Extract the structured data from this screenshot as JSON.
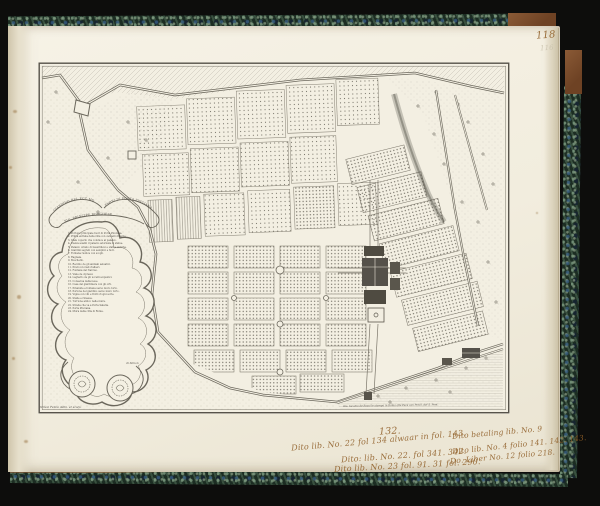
{
  "page": {
    "number": "118",
    "ghost_number": "116"
  },
  "map": {
    "banner": {
      "left": "GIARDINO DEL ECC.MO",
      "center": "SIG. PRINCIPE BORGHESE",
      "right": "FVORI DI PORTA PINCIANA"
    },
    "legend": "1. Portone principale fuori di Porta Pinciana.\n2. Prima entrata della villa con cancelli di ferro.\n3. Viale coperto che conduce al palazzo.\n4. Piazza auanti il palazzo adornata di statue.\n5. Palazzo ornato di bassirilievi e statue antiche.\n6. Giardini segreti con semplici e fiori.\n7. Fontana rustica con scogli.\n8. Ragnaia.\n9. Boschetto.\n10. Recinto de gli animali seluatici.\n11. Prati con viali d'alberi.\n12. Fontana del Narciso.\n13. Viale de cipressi.\n14. Laghetto de gli uccelli acquatici.\n15. Conserua della neue.\n16. Casa del giardiniere con gli orti.\n17. Piramide e fontana uerso muro torto.\n18. Portone del giardino uerso muro torto.\n19. Vigna con viti e frutti d'ogni sorte.\n20. Stalle e rimesse.\n21. Torrione antico nelle mura.\n22. Strada che va a Porta Salaria.\n23. Porta Pinciana.\n24. Mura della citta di Roma.",
    "legend_signature": "di Simon",
    "imprint_left": "Simon Felice delin. et sculp.",
    "imprint_right": "Gio. Iacomo de Rossi le stampa in Roma alla Pace con Priuil. del S. Pont."
  },
  "annotations": {
    "number": "132.",
    "left": [
      "Dito lib. No. 22 fol 134 alwaar in fol. 143.",
      "Dito: lib. No. 22. fol 341. 342.",
      "Dito lib. No. 23 fol. 91. 31 fol. 290."
    ],
    "right": [
      "Dito betaling lib. No. 9",
      "Dito lib. No. 4 folio 141. 142. 143.",
      "Do. Liber No. 12 folio 218."
    ]
  },
  "colors": {
    "background": "#0d0d0c",
    "paper": "#f3efe2",
    "engraving_ink": "#6b675c",
    "manuscript_ink": "#8f5e27",
    "marble_green": "#24382c",
    "leather_brown": "#8a5a36"
  }
}
